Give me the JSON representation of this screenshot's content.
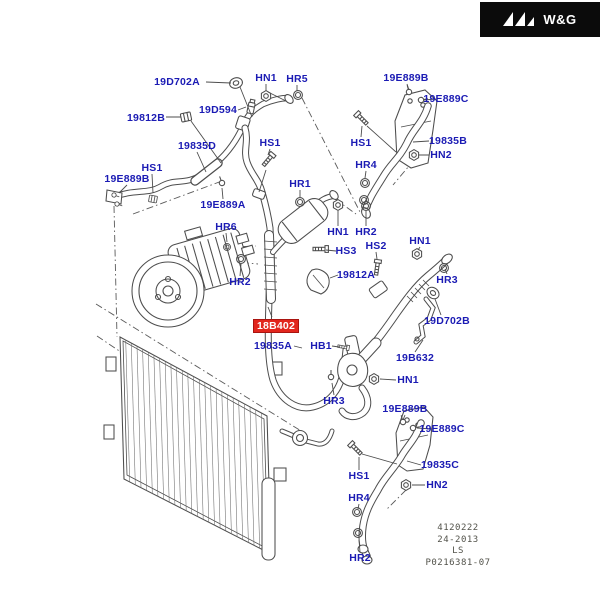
{
  "logo": {
    "text": "W&G",
    "icon": "triple-chevron-icon"
  },
  "plate": {
    "lines": [
      "4120222",
      "24-2013",
      "LS",
      "P0216381-07"
    ]
  },
  "colors": {
    "label_blue": "#1b1bb4",
    "highlight_bg": "#e2261d",
    "highlight_text": "#ffffff",
    "line": "#4d4d4d",
    "plate_text": "#52524a",
    "logo_bg": "#0b0b0b"
  },
  "highlighted_part": "18B402",
  "part_labels": [
    {
      "text": "19D702A",
      "x": 177,
      "y": 82
    },
    {
      "text": "HN1",
      "x": 266,
      "y": 78
    },
    {
      "text": "HR5",
      "x": 297,
      "y": 79
    },
    {
      "text": "19E889B",
      "x": 406,
      "y": 78
    },
    {
      "text": "19E889C",
      "x": 446,
      "y": 99
    },
    {
      "text": "19D594",
      "x": 218,
      "y": 110
    },
    {
      "text": "19812B",
      "x": 146,
      "y": 118
    },
    {
      "text": "19835D",
      "x": 197,
      "y": 146
    },
    {
      "text": "HS1",
      "x": 270,
      "y": 143
    },
    {
      "text": "HS1",
      "x": 361,
      "y": 143
    },
    {
      "text": "19835B",
      "x": 448,
      "y": 141
    },
    {
      "text": "HN2",
      "x": 441,
      "y": 155
    },
    {
      "text": "HS1",
      "x": 152,
      "y": 168
    },
    {
      "text": "HR4",
      "x": 366,
      "y": 165
    },
    {
      "text": "19E889B",
      "x": 127,
      "y": 179
    },
    {
      "text": "HR1",
      "x": 300,
      "y": 184
    },
    {
      "text": "19E889A",
      "x": 223,
      "y": 205
    },
    {
      "text": "HR6",
      "x": 226,
      "y": 227
    },
    {
      "text": "HN1",
      "x": 338,
      "y": 232
    },
    {
      "text": "HR2",
      "x": 366,
      "y": 232
    },
    {
      "text": "HN1",
      "x": 420,
      "y": 241
    },
    {
      "text": "HS2",
      "x": 376,
      "y": 246
    },
    {
      "text": "HS3",
      "x": 346,
      "y": 251
    },
    {
      "text": "19812A",
      "x": 356,
      "y": 275
    },
    {
      "text": "HR3",
      "x": 447,
      "y": 280
    },
    {
      "text": "HR2",
      "x": 240,
      "y": 282
    },
    {
      "text": "19D702B",
      "x": 447,
      "y": 321
    },
    {
      "text": "18B402",
      "x": 276,
      "y": 326,
      "highlight": true
    },
    {
      "text": "19835A",
      "x": 273,
      "y": 346
    },
    {
      "text": "HB1",
      "x": 321,
      "y": 346
    },
    {
      "text": "19B632",
      "x": 415,
      "y": 358
    },
    {
      "text": "HN1",
      "x": 408,
      "y": 380
    },
    {
      "text": "HR3",
      "x": 334,
      "y": 401
    },
    {
      "text": "19E889B",
      "x": 405,
      "y": 409
    },
    {
      "text": "19E889C",
      "x": 442,
      "y": 429
    },
    {
      "text": "19835C",
      "x": 440,
      "y": 465
    },
    {
      "text": "HS1",
      "x": 359,
      "y": 476
    },
    {
      "text": "HN2",
      "x": 437,
      "y": 485
    },
    {
      "text": "HR4",
      "x": 359,
      "y": 498
    },
    {
      "text": "HR2",
      "x": 360,
      "y": 558
    }
  ]
}
